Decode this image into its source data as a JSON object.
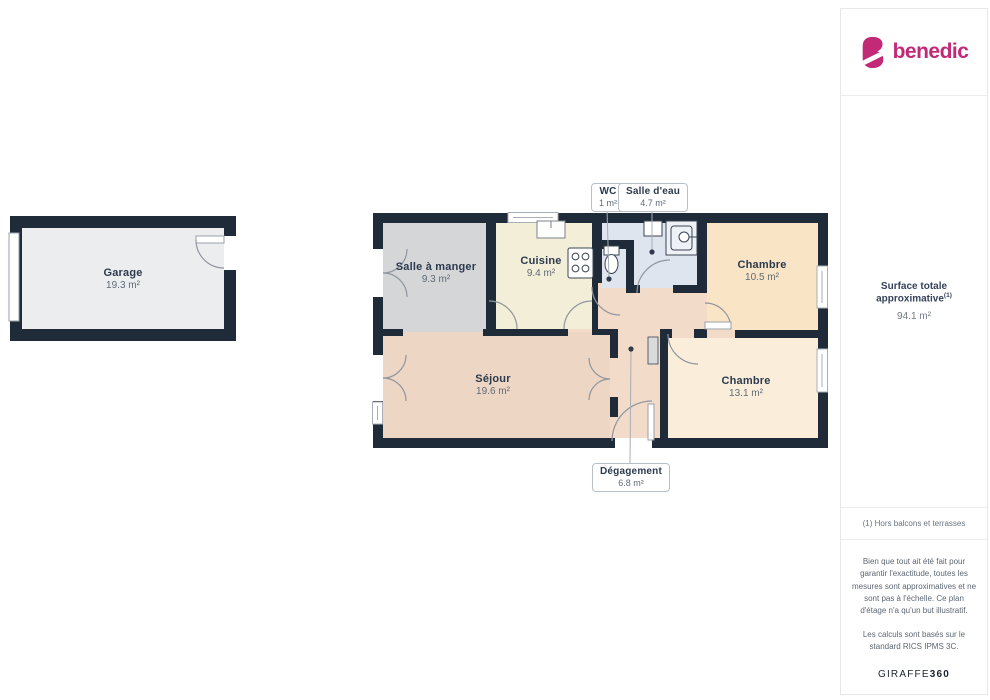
{
  "sidebar": {
    "brand": "benedic",
    "brand_color": "#c22a77",
    "surface_title": "Surface totale approximative",
    "surface_footnote_marker": "(1)",
    "surface_value": "94.1 m²",
    "footnote": "(1) Hors balcons et terrasses",
    "disclaimer1": "Bien que tout ait été fait pour garantir l'exactitude, toutes les mesures sont approximatives et ne sont pas à l'échelle. Ce plan d'étage n'a qu'un but illustratif.",
    "disclaimer2": "Les calculs sont basés sur le standard RICS IPMS 3C.",
    "brand2_regular": "GIRAFFE",
    "brand2_bold": "360"
  },
  "floorplan": {
    "rooms": [
      {
        "name": "Garage",
        "area": "19.3 m²"
      },
      {
        "name": "Salle à manger",
        "area": "9.3 m²"
      },
      {
        "name": "Cuisine",
        "area": "9.4 m²"
      },
      {
        "name": "WC",
        "area": "1 m²"
      },
      {
        "name": "Salle d'eau",
        "area": "4.7 m²"
      },
      {
        "name": "Chambre",
        "area": "10.5 m²"
      },
      {
        "name": "Séjour",
        "area": "19.6 m²"
      },
      {
        "name": "Chambre",
        "area": "13.1 m²"
      },
      {
        "name": "Dégagement",
        "area": "6.8 m²"
      }
    ],
    "colors": {
      "wall": "#1f2b38",
      "garage": "#ecedef",
      "dining": "#d4d6d8",
      "kitchen": "#f3eed8",
      "bath": "#dfe5ef",
      "bedroom1": "#f9e4c6",
      "bedroom2": "#faeedb",
      "living": "#eed6c5",
      "hallway": "#f3dbc9"
    }
  }
}
